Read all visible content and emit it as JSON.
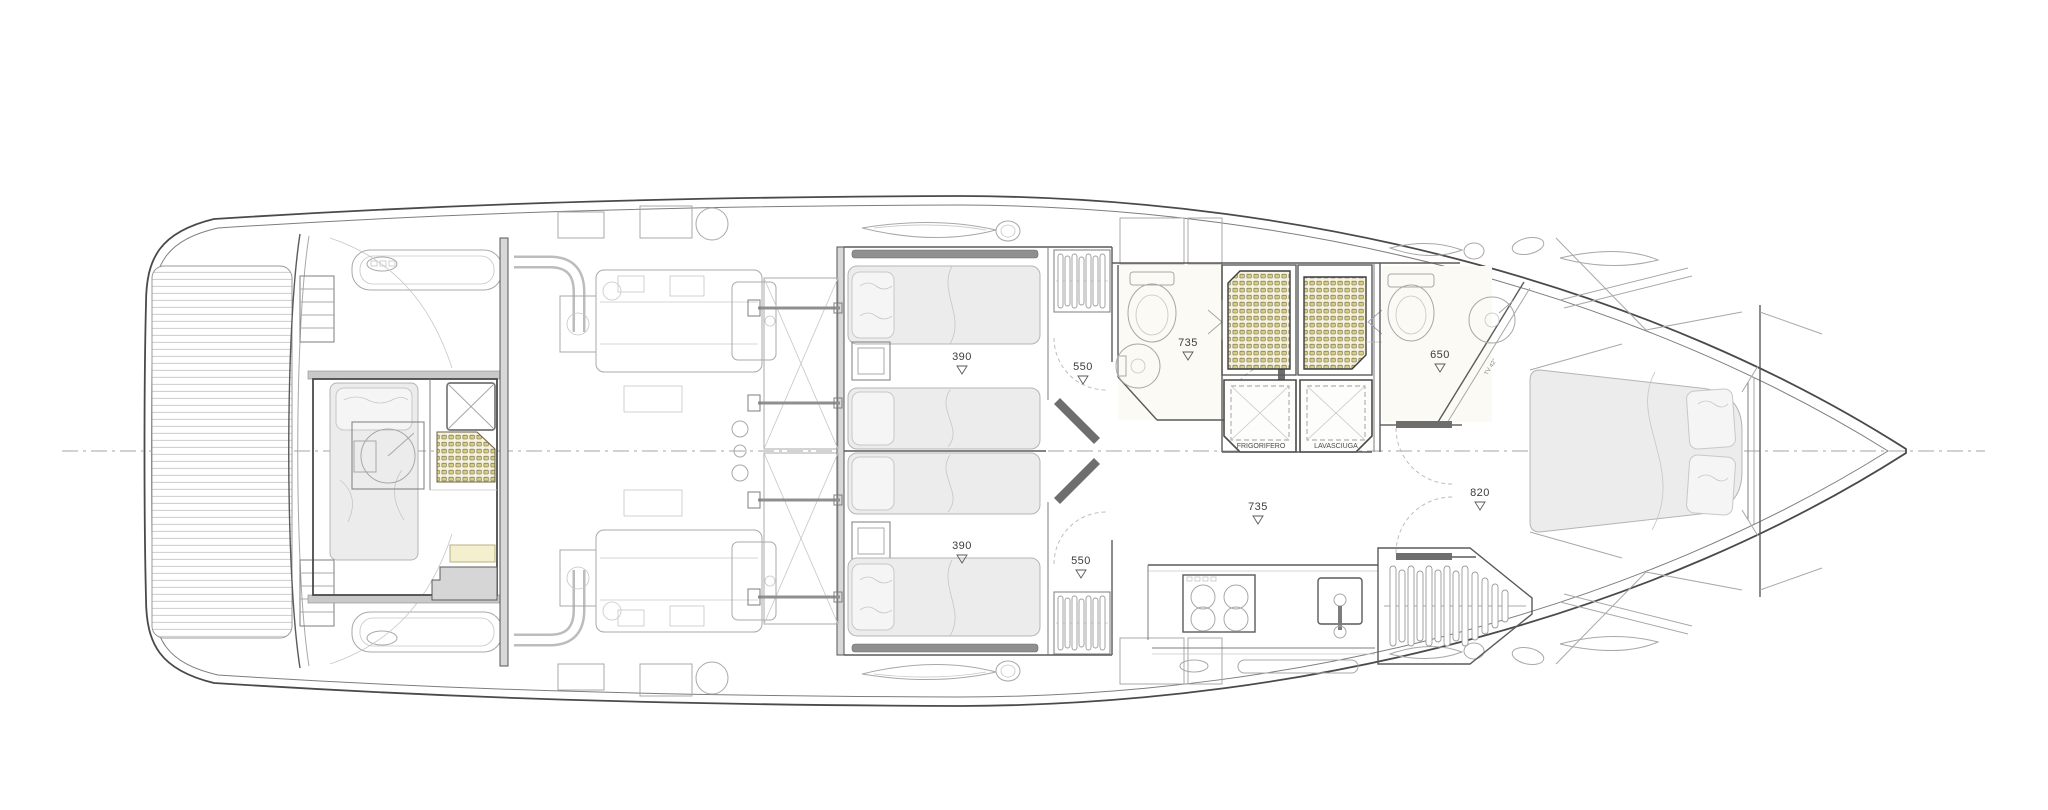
{
  "plan": {
    "dims": {
      "port_cabin": "390",
      "stbd_cabin": "390",
      "port_vestibule": "550",
      "stbd_vestibule": "550",
      "mid_bath": "735",
      "lobby": "735",
      "fwd_bath": "650",
      "vip_foyer": "820"
    },
    "appliances": {
      "fridge": "FRIGORIFERO",
      "washer": "LAVASCIUGA"
    },
    "annotations": {
      "tv": "TV 42\""
    },
    "colors": {
      "wall": "#4a4a4a",
      "light_line": "#9a9a9a",
      "bed_fill": "#ececec",
      "grate_cell": "#d8cd84",
      "grate_bg": "#f4f1dd",
      "deck_strip": "#c9c9c9"
    }
  }
}
